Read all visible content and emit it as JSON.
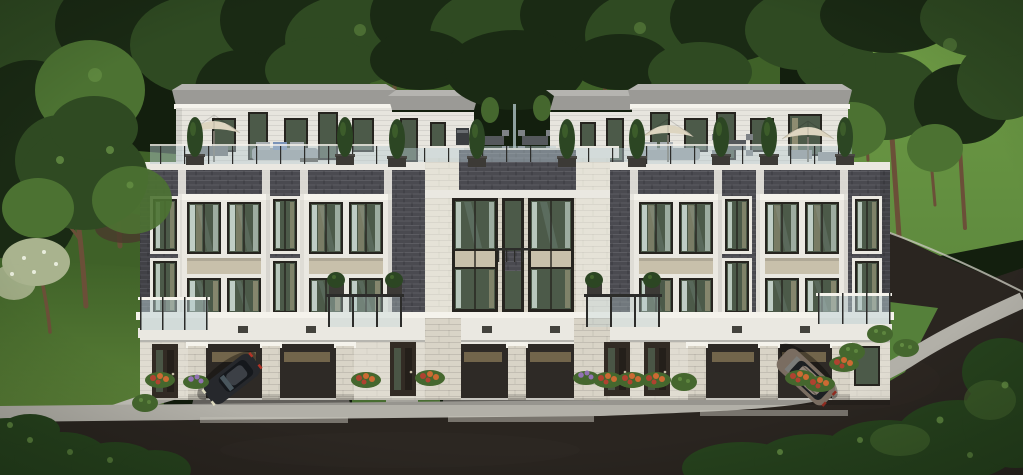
{
  "caption": {
    "title": "Dusk exterior rendering of a modern townhome block",
    "description": "Three-storey modern townhouses with dark grey brick, white stone window bays and a central stone tower; rooftop terraces with patio furniture, cream umbrellas and cypress planters; ground-level carports with driveways; a dark sedan and a grey-brown SUV parked; dense forest behind, grassy hill and curved asphalt road on the right, sidewalk and flower beds in front."
  },
  "scene": {
    "type": "3D architectural exterior rendering",
    "storeys": "3 plus rooftop terraces",
    "driveways": "3",
    "vehicles": [
      "dark sedan",
      "grey-brown SUV"
    ],
    "landscaping": [
      "forest backdrop",
      "front lawns",
      "flower beds",
      "corner shrubs",
      "curved road"
    ]
  },
  "palette": {
    "bgBase": "#131f0e",
    "forestDark": "#1a2a14",
    "forestMid": "#2f4a22",
    "forestLight": "#4c7232",
    "forestHighlight": "#6e9a4a",
    "trunk": "#6b4f38",
    "grassBack": "#3f6128",
    "grassLawn": "#5c8238",
    "grassHill": "#6f9c45",
    "grassStrip": "#55803a",
    "roadAsphalt": "#2a2520",
    "roadLight": "#3a332c",
    "sidewalk": "#b2b0a8",
    "curbLight": "#c6c4ba",
    "driveTop": "#565250",
    "driveBottom": "#7b7873",
    "brickField": "#4a4a50",
    "whiteTrim": "#eae8e1",
    "whiteBright": "#f5f3ec",
    "whiteSiding": "#e7e5de",
    "stoneLight": "#d9d4c7",
    "spandrelBeige": "#c8c0ab",
    "windowFrame": "#26241f",
    "glassDark": "#4c5a49",
    "glassReflect": "#9db4b4",
    "curtainLight": "#d3e2da",
    "curtainWarm": "#cdbd9a",
    "roofGray": "#9b9a96",
    "roofLight": "#b5b4b0",
    "umbrellaCream": "#ddd5c0",
    "railingGlass": "#b9cdd2",
    "railingDark": "#2c2c2a",
    "cypressGreen": "#2c4623",
    "shrubGreen": "#45672e",
    "bushDark": "#26421d",
    "flowerOrange": "#cc6a33",
    "flowerRed": "#b04230",
    "flowerPurple": "#9272b4",
    "flowerWhite": "#e8ecdc",
    "blossomSage": "#a9b38e",
    "carBody": "#26282c",
    "carGlass": "#15181c",
    "carShine": "#7e949e",
    "suvBody": "#7a6d61",
    "suvRoof": "#90847a",
    "suvGlass": "#1c1f22",
    "doorDark": "#322b24",
    "interiorDark": "#2e2a26",
    "garageSlat": "#8a7a58",
    "planterDark": "#3c3a36",
    "pathConcrete": "#c2c0b8",
    "porchConcrete": "#b7b5ad"
  }
}
